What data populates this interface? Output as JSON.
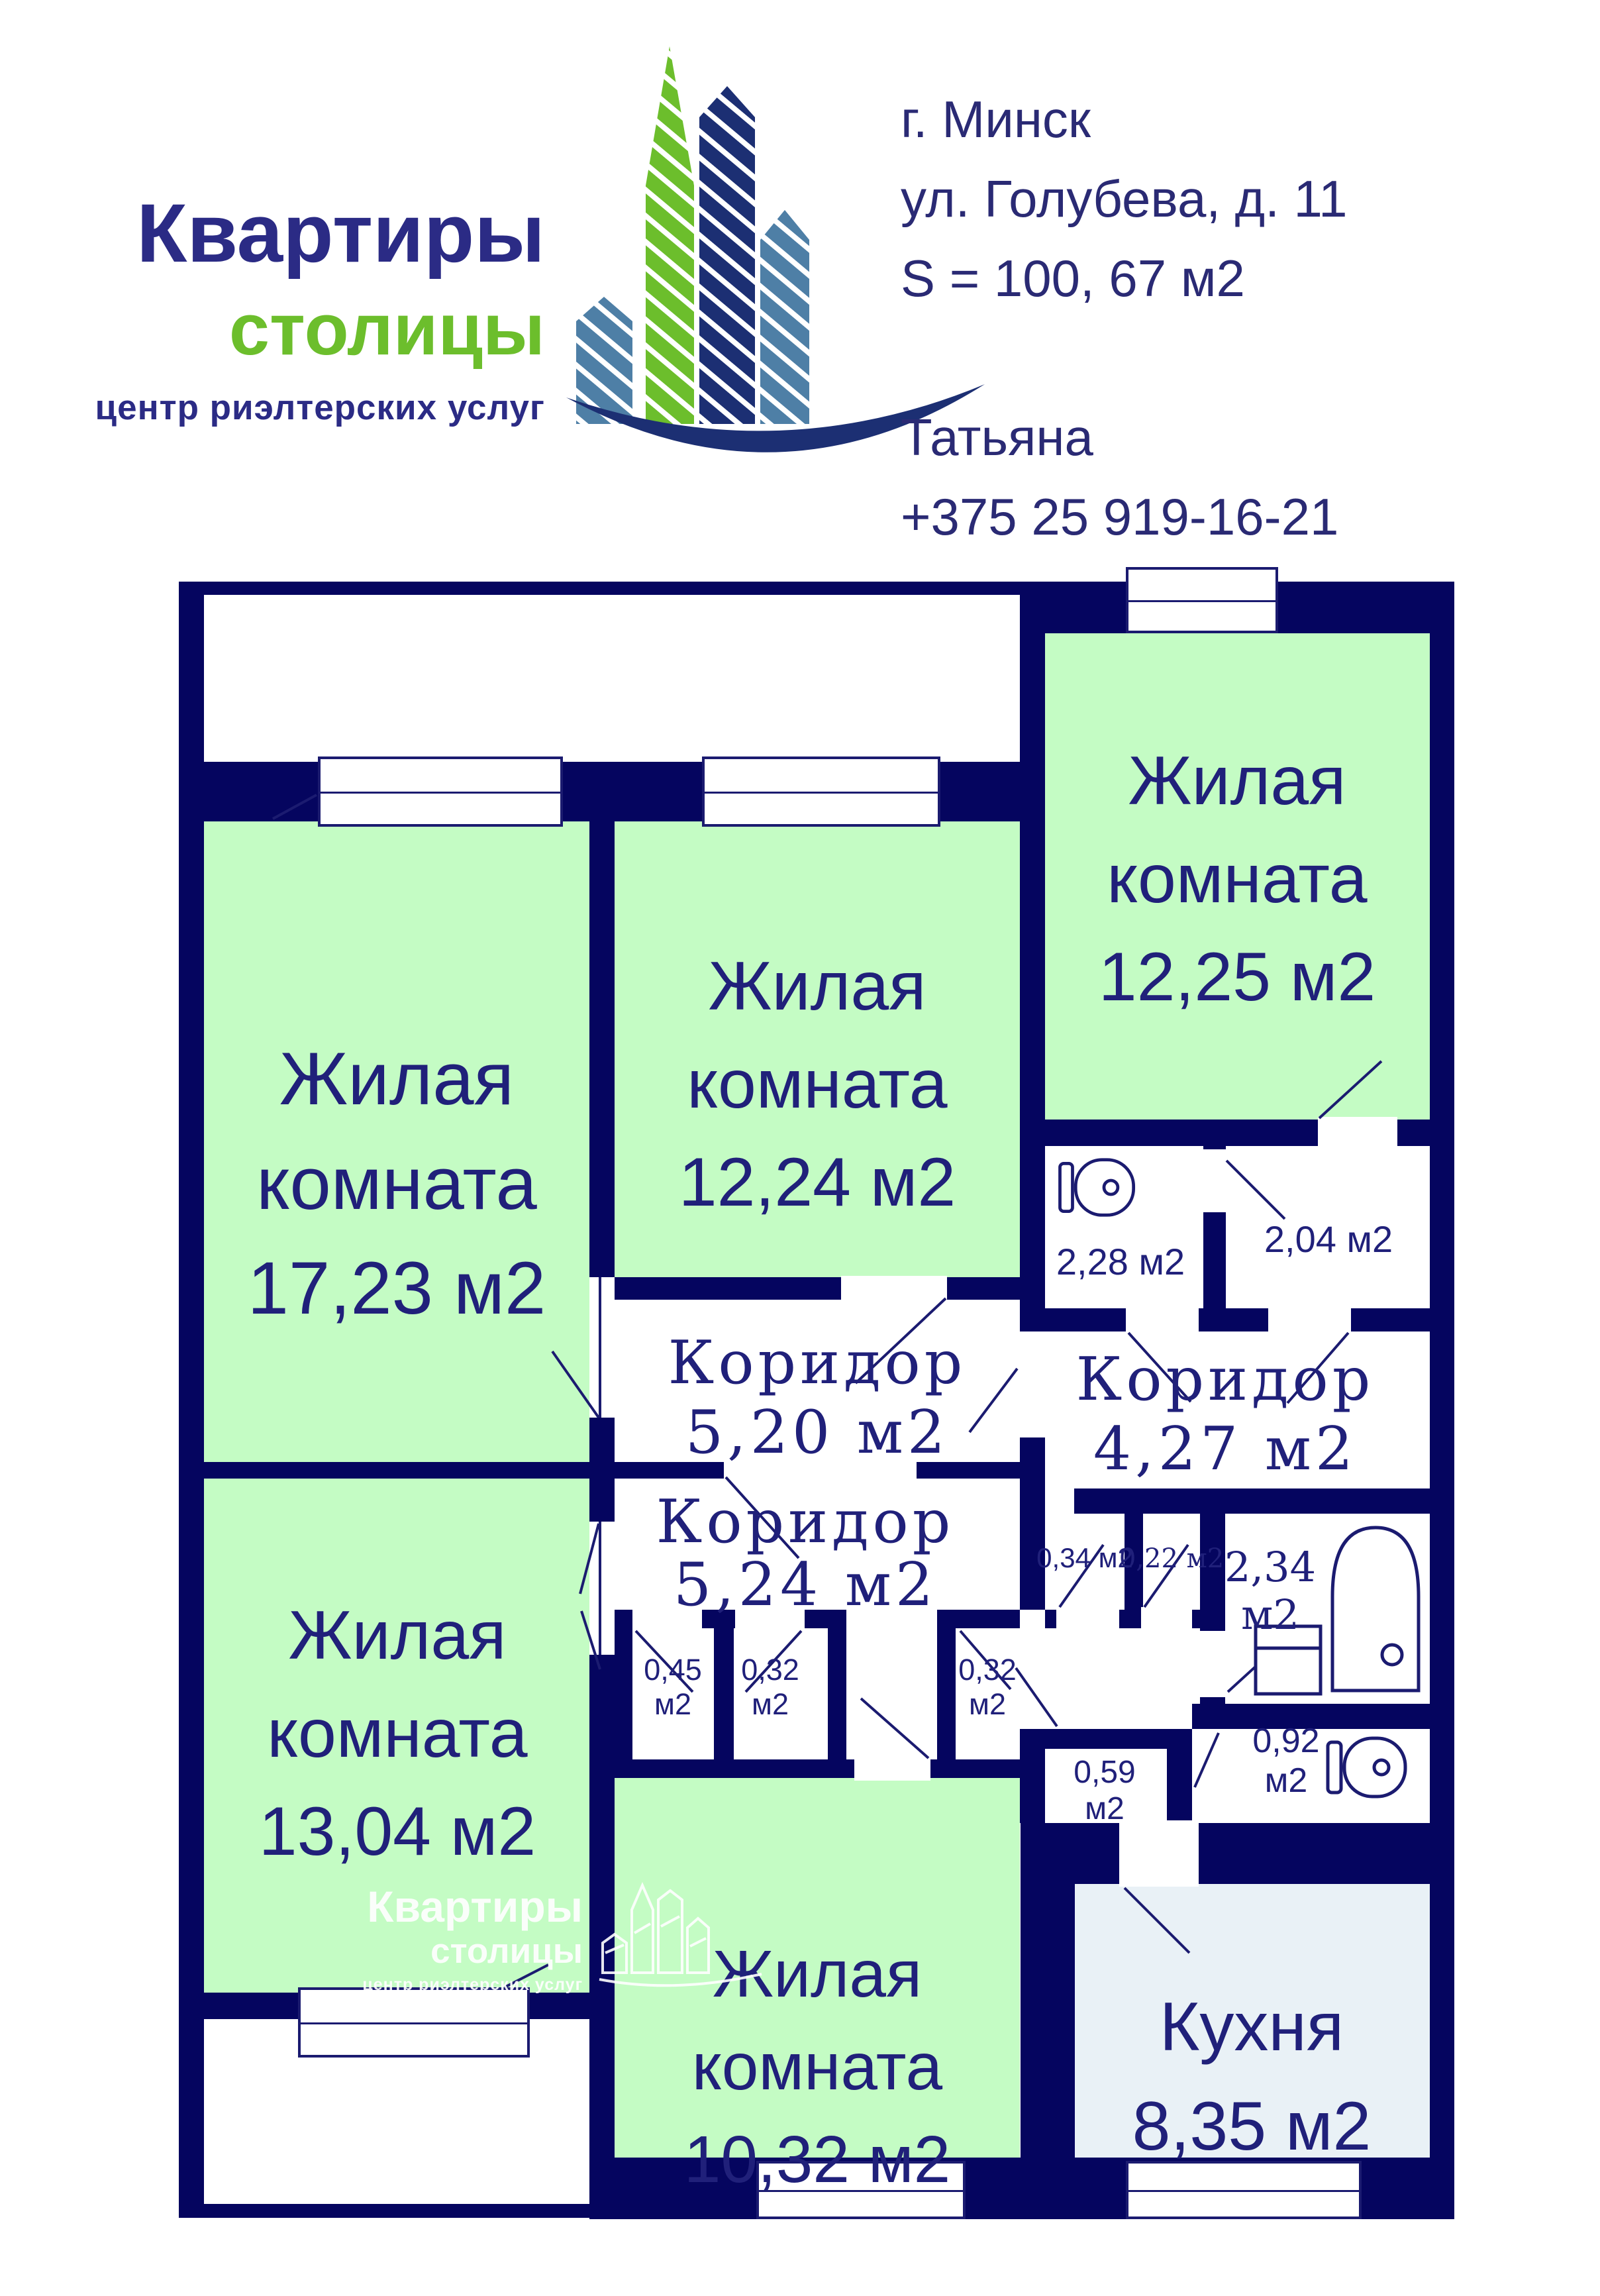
{
  "header": {
    "logo": {
      "title": "Квартиры",
      "subtitle": "столицы",
      "tagline": "центр риэлтерских услуг"
    },
    "info": {
      "city": "г. Минск",
      "address": "ул. Голубева, д. 11",
      "total_area": "S = 100, 67 м2",
      "agent_name": "Татьяна",
      "phone": "+375 25 919-16-21"
    }
  },
  "watermark": {
    "title": "Квартиры",
    "subtitle": "столицы",
    "tagline": "центр риэлтерских услуг"
  },
  "colors": {
    "wall_navy": "#05055f",
    "room_green": "#c4fcc4",
    "kitchen_blue": "#e9f1f6",
    "text_navy": "#20207a",
    "logo_green": "#6cbe2c",
    "logo_navy": "#2b2b85",
    "logo_steel": "#4e7fa6"
  },
  "rooms": {
    "r1723": {
      "lines": [
        "Жилая",
        "комната",
        "17,23 м2"
      ]
    },
    "r1224": {
      "lines": [
        "Жилая",
        "комната",
        "12,24 м2"
      ]
    },
    "r1225": {
      "lines": [
        "Жилая",
        "комната",
        "12,25 м2"
      ]
    },
    "r1304": {
      "lines": [
        "Жилая",
        "комната",
        "13,04 м2"
      ]
    },
    "r1032": {
      "lines": [
        "Жилая",
        "комната",
        "10,32 м2"
      ]
    },
    "kitchen": {
      "lines": [
        "Кухня",
        "8,35 м2"
      ]
    },
    "cor520": {
      "lines": [
        "Коридор",
        "5,20 м2"
      ]
    },
    "cor427": {
      "lines": [
        "Коридор",
        "4,27 м2"
      ]
    },
    "cor524": {
      "lines": [
        "Коридор",
        "5,24 м2"
      ]
    },
    "wc228": {
      "label": "2,28 м2"
    },
    "st204": {
      "label": "2,04 м2"
    },
    "c034": {
      "label": "0,34 м2"
    },
    "c022": {
      "label": "0,22 м2"
    },
    "bath234": {
      "lines": [
        "2,34",
        "м2"
      ]
    },
    "c045": {
      "lines": [
        "0,45",
        "м2"
      ]
    },
    "c032a": {
      "lines": [
        "0,32",
        "м2"
      ]
    },
    "c032b": {
      "lines": [
        "0,32",
        "м2"
      ]
    },
    "c059": {
      "lines": [
        "0,59",
        "м2"
      ]
    },
    "wc092": {
      "lines": [
        "0,92",
        "м2"
      ]
    }
  }
}
